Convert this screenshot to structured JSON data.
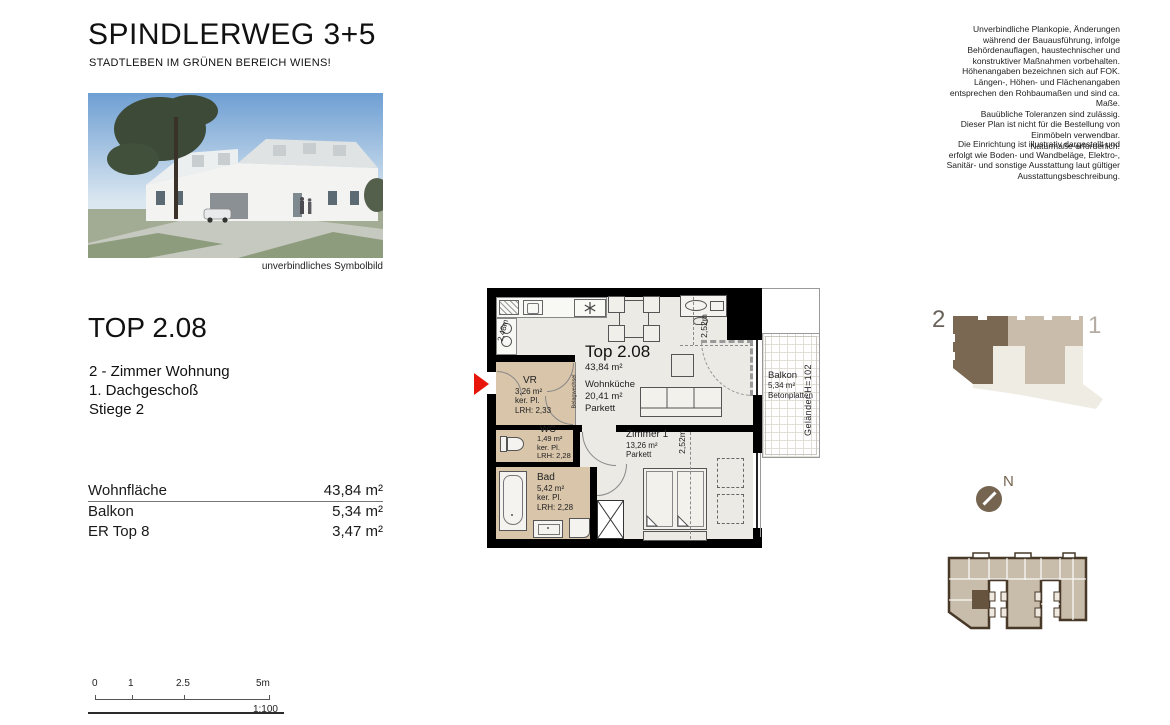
{
  "header": {
    "title": "SPINDLERWEG 3+5",
    "subtitle": "STADTLEBEN IM GRÜNEN BEREICH WIENS!"
  },
  "disclaimer": {
    "para1": "Unverbindliche Plankopie, Änderungen\nwährend der Bauausführung, infolge\nBehördenauflagen, haustechnischer und\nkonstruktiver Maßnahmen vorbehalten.\nHöhenangaben bezeichnen sich auf FOK.\nLängen-, Höhen- und Flächenangaben\nentsprechen den Rohbaumaßen und sind ca.\nMaße.\nBauübliche Toleranzen sind zulässig.\nDieser Plan ist nicht für die Bestellung von\nEinmöbeln verwendbar.\nNaturmaße erforderlich!",
    "para2": "Die Einrichtung ist illustrativ dargestellt und\nerfolgt wie Boden- und Wandbeläge, Elektro-,\nSanitär- und sonstige Ausstattung laut gültiger\nAusstattungsbeschreibung."
  },
  "photo": {
    "caption": "unverbindliches Symbolbild"
  },
  "unit": {
    "title": "TOP 2.08",
    "type": "2 - Zimmer Wohnung",
    "floor": "1. Dachgeschoß",
    "stair": "Stiege 2"
  },
  "areas": {
    "rows": [
      {
        "label": "Wohnfläche",
        "value": "43,84 m²"
      },
      {
        "label": "Balkon",
        "value": "5,34 m²"
      },
      {
        "label": "ER Top 8",
        "value": "3,47 m²"
      }
    ]
  },
  "plan": {
    "unit_label": "Top 2.08",
    "unit_area": "43,84 m²",
    "rooms": {
      "wohnkueche": {
        "name": "Wohnküche",
        "area": "20,41 m²",
        "floor": "Parkett"
      },
      "vr": {
        "name": "VR",
        "area": "3,26 m²",
        "floor": "ker. Pl.",
        "lrh": "LRH: 2,33"
      },
      "wc": {
        "name": "WC",
        "area": "1,49 m²",
        "floor": "ker. Pl.",
        "lrh": "LRH: 2,28"
      },
      "bad": {
        "name": "Bad",
        "area": "5,42 m²",
        "floor": "ker. Pl.",
        "lrh": "LRH: 2,28"
      },
      "zimmer1": {
        "name": "Zimmer 1",
        "area": "13,26 m²",
        "floor": "Parkett"
      },
      "balkon": {
        "name": "Balkon",
        "area": "5,34 m²",
        "floor": "Betonplatten"
      }
    },
    "annotations": {
      "gelaender": "Geländer H=102",
      "belagwechsel": "Belagwechsel",
      "dim_kitchen": "2,48m",
      "dim_living": "2,52m",
      "dim_zimmer": "2,52m"
    }
  },
  "key_diagram": {
    "stiege2_label": "2",
    "stiege1_label": "1"
  },
  "compass": {
    "north_label": "N"
  },
  "scalebar": {
    "ticks": [
      "0",
      "1",
      "2.5",
      "5m"
    ],
    "ratio": "1:100"
  },
  "colors": {
    "accent_red": "#E8150A",
    "room_beige": "#D8C5AA",
    "floor_grey": "#ECEAE4",
    "key_dark": "#6B5948",
    "key_mid": "#C9BCAB",
    "key_light": "#EFECE4"
  }
}
